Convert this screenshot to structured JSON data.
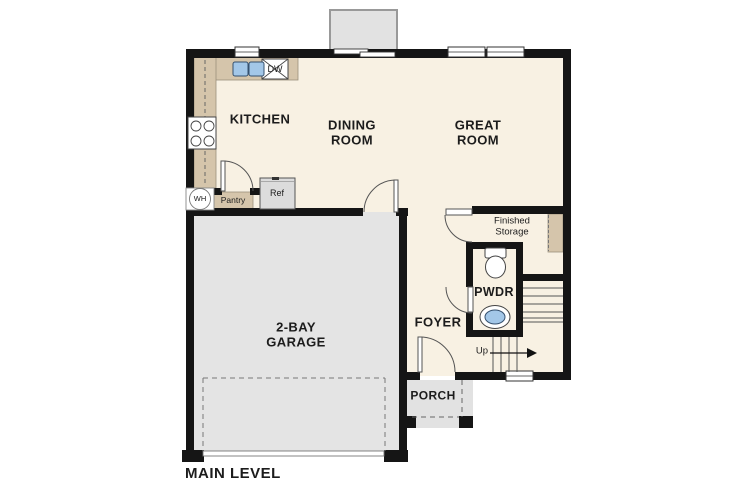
{
  "plan": {
    "title": "MAIN LEVEL",
    "rooms": {
      "kitchen": "KITCHEN",
      "dining_room": "DINING ROOM",
      "great_room": "GREAT ROOM",
      "garage": "2-BAY GARAGE",
      "foyer": "FOYER",
      "powder_room": "PWDR",
      "porch": "PORCH",
      "finished_storage": "Finished Storage"
    },
    "fixtures": {
      "dishwasher": "DW",
      "water_heater": "WH",
      "pantry": "Pantry",
      "refrigerator": "Ref",
      "stairs_direction": "Up"
    },
    "colors": {
      "wall": "#151515",
      "floor": "#f8f1e3",
      "garage_floor": "#e4e4e4",
      "porch_floor": "#e2e2e2",
      "counter": "#d5c5ab",
      "sink_blue": "#a3c7e8"
    }
  }
}
